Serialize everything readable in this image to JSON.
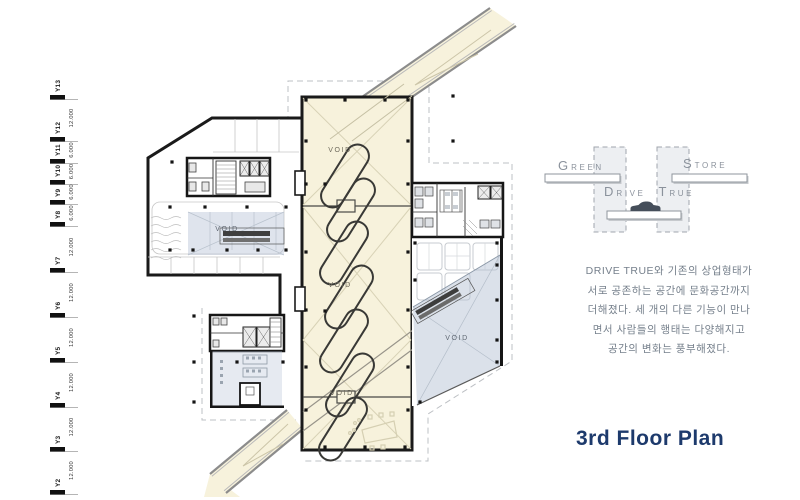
{
  "title": {
    "label": "3rd Floor Plan"
  },
  "grid_ruler": {
    "labels": [
      "Y13",
      "Y12",
      "Y11",
      "Y10",
      "Y9",
      "Y8",
      "Y7",
      "Y6",
      "Y5",
      "Y4",
      "Y3",
      "Y2"
    ],
    "dims": [
      "12.000",
      "6.000",
      "6.000",
      "6.000",
      "6.000",
      "12.000",
      "12.000",
      "12.000",
      "12.000",
      "12.000",
      "12.000"
    ]
  },
  "plan": {
    "void_labels": {
      "strip_top": "VOID",
      "strip_mid": "VOID",
      "strip_bottom": "VOID",
      "left_wing": "VOID",
      "right_wing": "VOID"
    }
  },
  "concept_diagram": {
    "green": {
      "initial": "G",
      "rest": "REEN"
    },
    "store": {
      "initial": "S",
      "rest": "TORE"
    },
    "drive": {
      "initial": "D",
      "rest": "RIVE"
    },
    "true_word": {
      "initial": "T",
      "rest": "RUE"
    },
    "car_icon": "car-silhouette"
  },
  "description": {
    "lines": [
      "DRIVE TRUE와 기존의 상업형태가",
      "서로 공존하는 공간에 문화공간까지",
      "더해졌다. 세 개의 다른 기능이 만나",
      "면서 사람들의 행태는 다양해지고",
      "공간의 변화는 풍부해졌다."
    ]
  },
  "colors": {
    "ramp_cream": "#f7f2dc",
    "void_blue": "#b7c4d6",
    "title_navy": "#1d3a6c",
    "diagram_gray": "#8b929c",
    "text_gray": "#76808c"
  }
}
